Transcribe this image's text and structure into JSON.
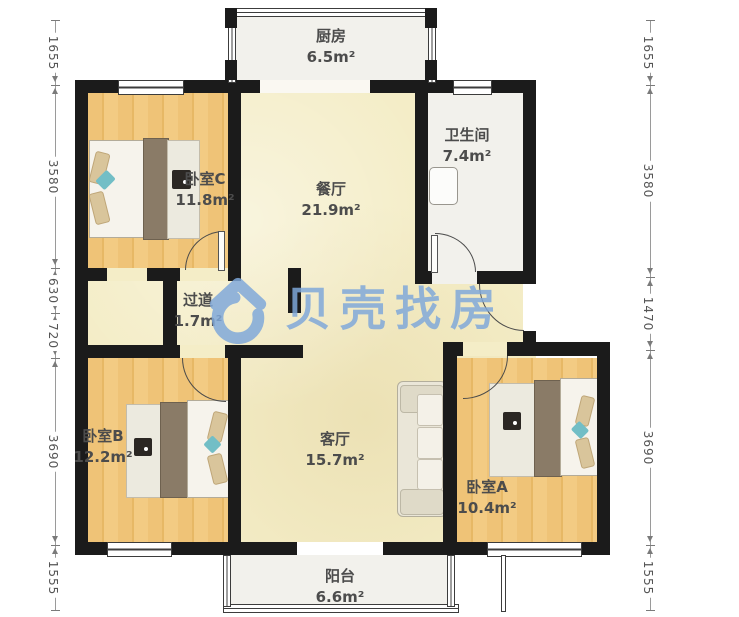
{
  "brand": {
    "watermark": "贝壳找房"
  },
  "rooms": [
    {
      "name": "厨房",
      "area": "6.5m²"
    },
    {
      "name": "卫生间",
      "area": "7.4m²"
    },
    {
      "name": "卧室C",
      "area": "11.8m²"
    },
    {
      "name": "餐厅",
      "area": "21.9m²"
    },
    {
      "name": "过道",
      "area": "1.7m²"
    },
    {
      "name": "卧室B",
      "area": "12.2m²"
    },
    {
      "name": "客厅",
      "area": "15.7m²"
    },
    {
      "name": "卧室A",
      "area": "10.4m²"
    },
    {
      "name": "阳台",
      "area": "6.6m²"
    }
  ],
  "dimensions_mm": {
    "left": [
      "1655",
      "3580",
      "630",
      "720",
      "3690",
      "1555"
    ],
    "right": [
      "1655",
      "3580",
      "1470",
      "3690",
      "1555"
    ]
  },
  "colors": {
    "wall": "#1b1b1b",
    "wood_floor": "#efc377",
    "hall_floor": "#f4edc7",
    "wet_floor": "#f2f1ec",
    "watermark_blue": "#7fa8da",
    "accent_teal": "#72bec6"
  }
}
